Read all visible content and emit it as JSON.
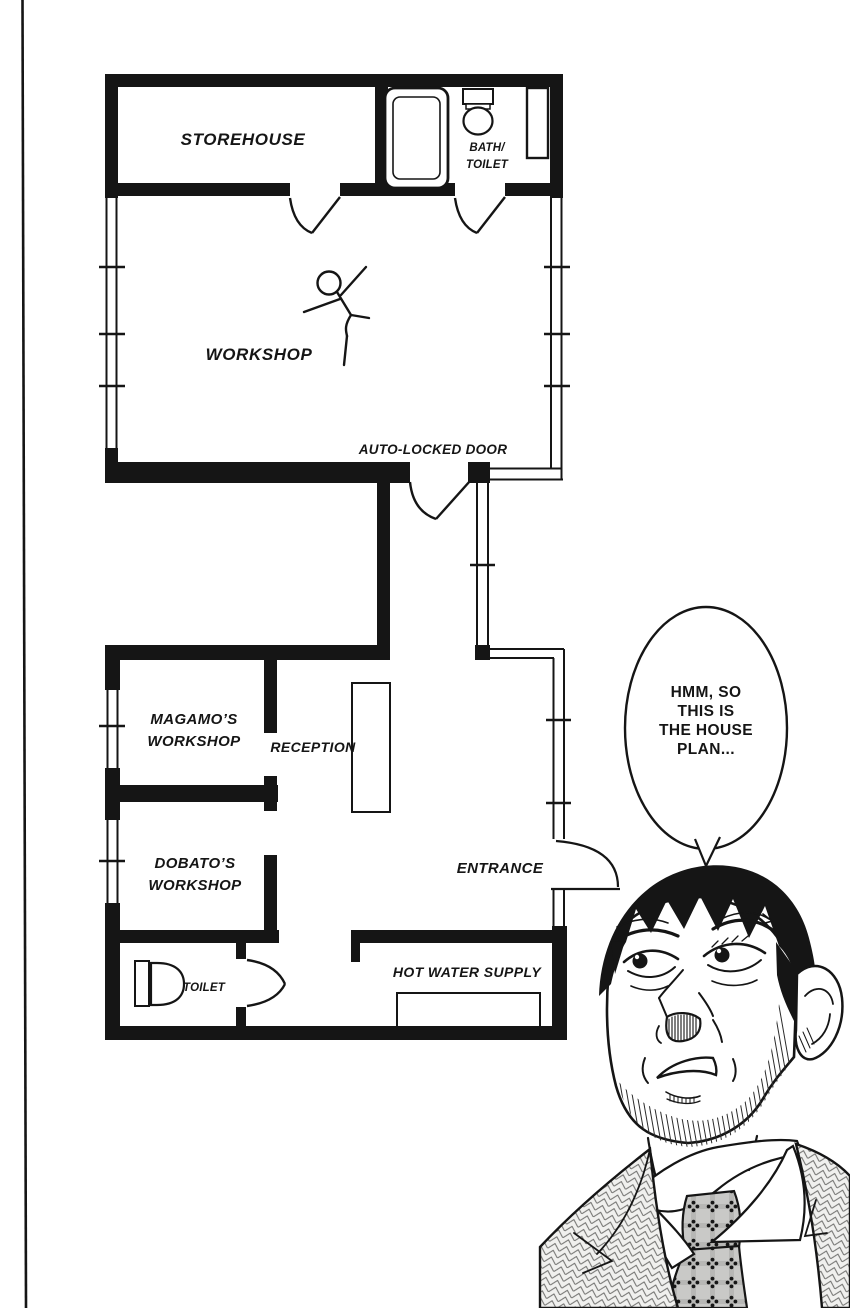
{
  "colors": {
    "ink": "#151515",
    "paper": "#ffffff",
    "tie_base": "#c9c9c7"
  },
  "floor_plan": {
    "labels": {
      "storehouse": "STOREHOUSE",
      "bath_toilet": [
        "BATH/",
        "TOILET"
      ],
      "workshop": "WORKSHOP",
      "auto_locked_door": "AUTO-LOCKED DOOR",
      "magamo_workshop": [
        "MAGAMO’S",
        "WORKSHOP"
      ],
      "reception": "RECEPTION",
      "dobato_workshop": [
        "DOBATO’S",
        "WORKSHOP"
      ],
      "entrance": "ENTRANCE",
      "toilet": "TOILET",
      "hot_water_supply": "HOT WATER SUPPLY"
    }
  },
  "speech_bubble": {
    "lines": [
      "HMM, SO",
      "THIS IS",
      "THE HOUSE",
      "PLAN..."
    ]
  }
}
